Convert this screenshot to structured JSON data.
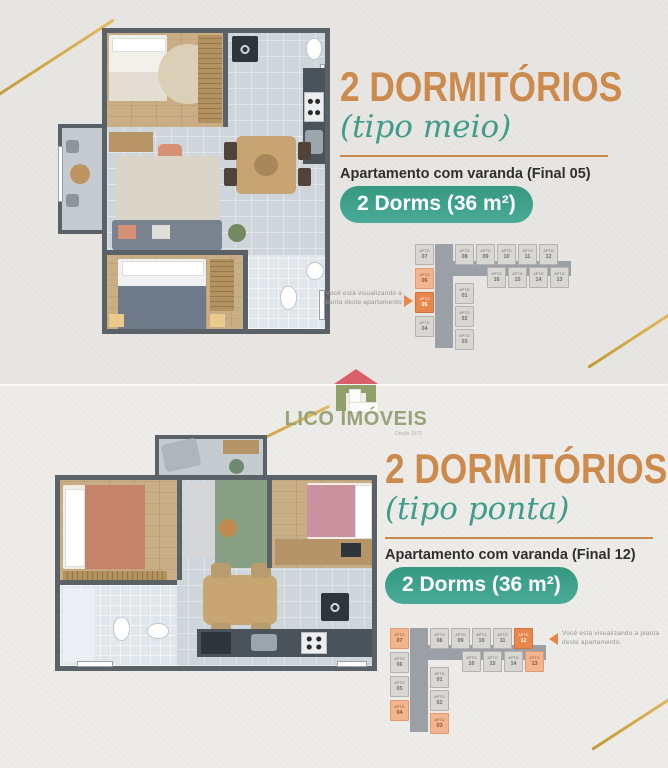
{
  "brand": {
    "name": "LICO IMÓVEIS",
    "tagline": "Desde 1975"
  },
  "sections": [
    {
      "title": "2 DORMITÓRIOS",
      "subtitle": "(tipo meio)",
      "description": "Apartamento com varanda (Final 05)",
      "badge": "2 Dorms (36 m²)",
      "note": "Você está visualizando a planta deste apartamento",
      "highlighted_unit": "APTO 05"
    },
    {
      "title": "2 DORMITÓRIOS",
      "subtitle": "(tipo ponta)",
      "description": "Apartamento com varanda (Final 12)",
      "badge": "2 Dorms (36 m²)",
      "note": "Você está visualizando a planta deste apartamento.",
      "highlighted_unit": "APTO 12"
    }
  ],
  "building_maps": {
    "meio": {
      "label": "APTO",
      "units": [
        {
          "num": "07",
          "x": 2,
          "y": 2,
          "s": "base"
        },
        {
          "num": "06",
          "x": 2,
          "y": 26,
          "s": "hl"
        },
        {
          "num": "05",
          "x": 2,
          "y": 50,
          "s": "strong"
        },
        {
          "num": "04",
          "x": 2,
          "y": 74,
          "s": "base"
        },
        {
          "num": "08",
          "x": 42,
          "y": 2,
          "s": "base"
        },
        {
          "num": "09",
          "x": 63,
          "y": 2,
          "s": "base"
        },
        {
          "num": "10",
          "x": 84,
          "y": 2,
          "s": "base"
        },
        {
          "num": "11",
          "x": 105,
          "y": 2,
          "s": "base"
        },
        {
          "num": "12",
          "x": 126,
          "y": 2,
          "s": "base"
        },
        {
          "num": "16",
          "x": 74,
          "y": 25,
          "s": "base"
        },
        {
          "num": "15",
          "x": 95,
          "y": 25,
          "s": "base"
        },
        {
          "num": "14",
          "x": 116,
          "y": 25,
          "s": "base"
        },
        {
          "num": "13",
          "x": 137,
          "y": 25,
          "s": "base"
        },
        {
          "num": "01",
          "x": 42,
          "y": 41,
          "s": "base"
        },
        {
          "num": "02",
          "x": 42,
          "y": 64,
          "s": "base"
        },
        {
          "num": "03",
          "x": 42,
          "y": 87,
          "s": "base"
        }
      ]
    },
    "ponta": {
      "label": "APTO",
      "units": [
        {
          "num": "07",
          "x": 2,
          "y": 2,
          "s": "hl"
        },
        {
          "num": "06",
          "x": 2,
          "y": 26,
          "s": "base"
        },
        {
          "num": "05",
          "x": 2,
          "y": 50,
          "s": "base"
        },
        {
          "num": "04",
          "x": 2,
          "y": 74,
          "s": "hl"
        },
        {
          "num": "08",
          "x": 42,
          "y": 2,
          "s": "base"
        },
        {
          "num": "09",
          "x": 63,
          "y": 2,
          "s": "base"
        },
        {
          "num": "10",
          "x": 84,
          "y": 2,
          "s": "base"
        },
        {
          "num": "11",
          "x": 105,
          "y": 2,
          "s": "base"
        },
        {
          "num": "12",
          "x": 126,
          "y": 2,
          "s": "strong"
        },
        {
          "num": "16",
          "x": 74,
          "y": 25,
          "s": "base"
        },
        {
          "num": "15",
          "x": 95,
          "y": 25,
          "s": "base"
        },
        {
          "num": "14",
          "x": 116,
          "y": 25,
          "s": "base"
        },
        {
          "num": "13",
          "x": 137,
          "y": 25,
          "s": "hl"
        },
        {
          "num": "01",
          "x": 42,
          "y": 41,
          "s": "base"
        },
        {
          "num": "02",
          "x": 42,
          "y": 64,
          "s": "base"
        },
        {
          "num": "03",
          "x": 42,
          "y": 87,
          "s": "hl"
        }
      ]
    }
  },
  "colors": {
    "title_orange": "#cc8a4c",
    "subtitle_teal": "#3f9b8a",
    "badge_teal": "#3ca08d",
    "unit_highlight": "#e8864c",
    "unit_soft_highlight": "#f3b58f",
    "gold_line": "#d4a843",
    "background_top": "#e8e6e2",
    "background_bottom": "#edece9",
    "logo_green": "#99a278",
    "logo_roof_red": "#d9606b"
  }
}
